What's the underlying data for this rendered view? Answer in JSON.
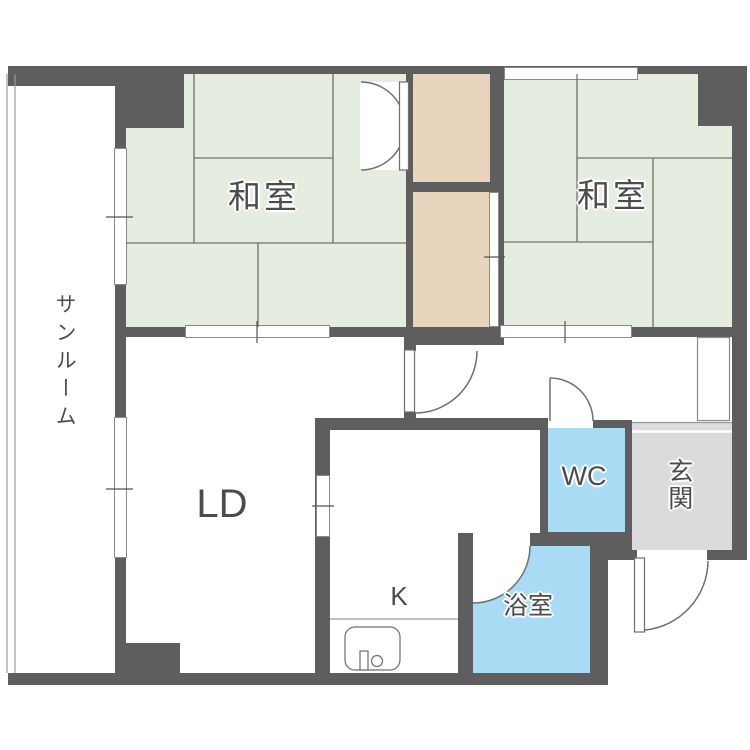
{
  "plan_title": "1LDK+2和室 floor plan",
  "colors": {
    "bg": "#ffffff",
    "wall": "#5e5e5e",
    "tatami": "#e5ede1",
    "closet": "#e9d4bd",
    "water": "#a9dbf4",
    "genkan": "#dbdbdb",
    "line": "#6f6f6f",
    "label": "#4c4c4c"
  },
  "rooms": {
    "washitsu_left": {
      "label": "和室"
    },
    "washitsu_right": {
      "label": "和室"
    },
    "sunroom": {
      "label": "サンルーム"
    },
    "living_dining": {
      "label": "LD"
    },
    "kitchen": {
      "label": "K"
    },
    "wc": {
      "label": "WC"
    },
    "genkan": {
      "label": "玄関"
    },
    "bathroom": {
      "label": "浴室"
    }
  }
}
